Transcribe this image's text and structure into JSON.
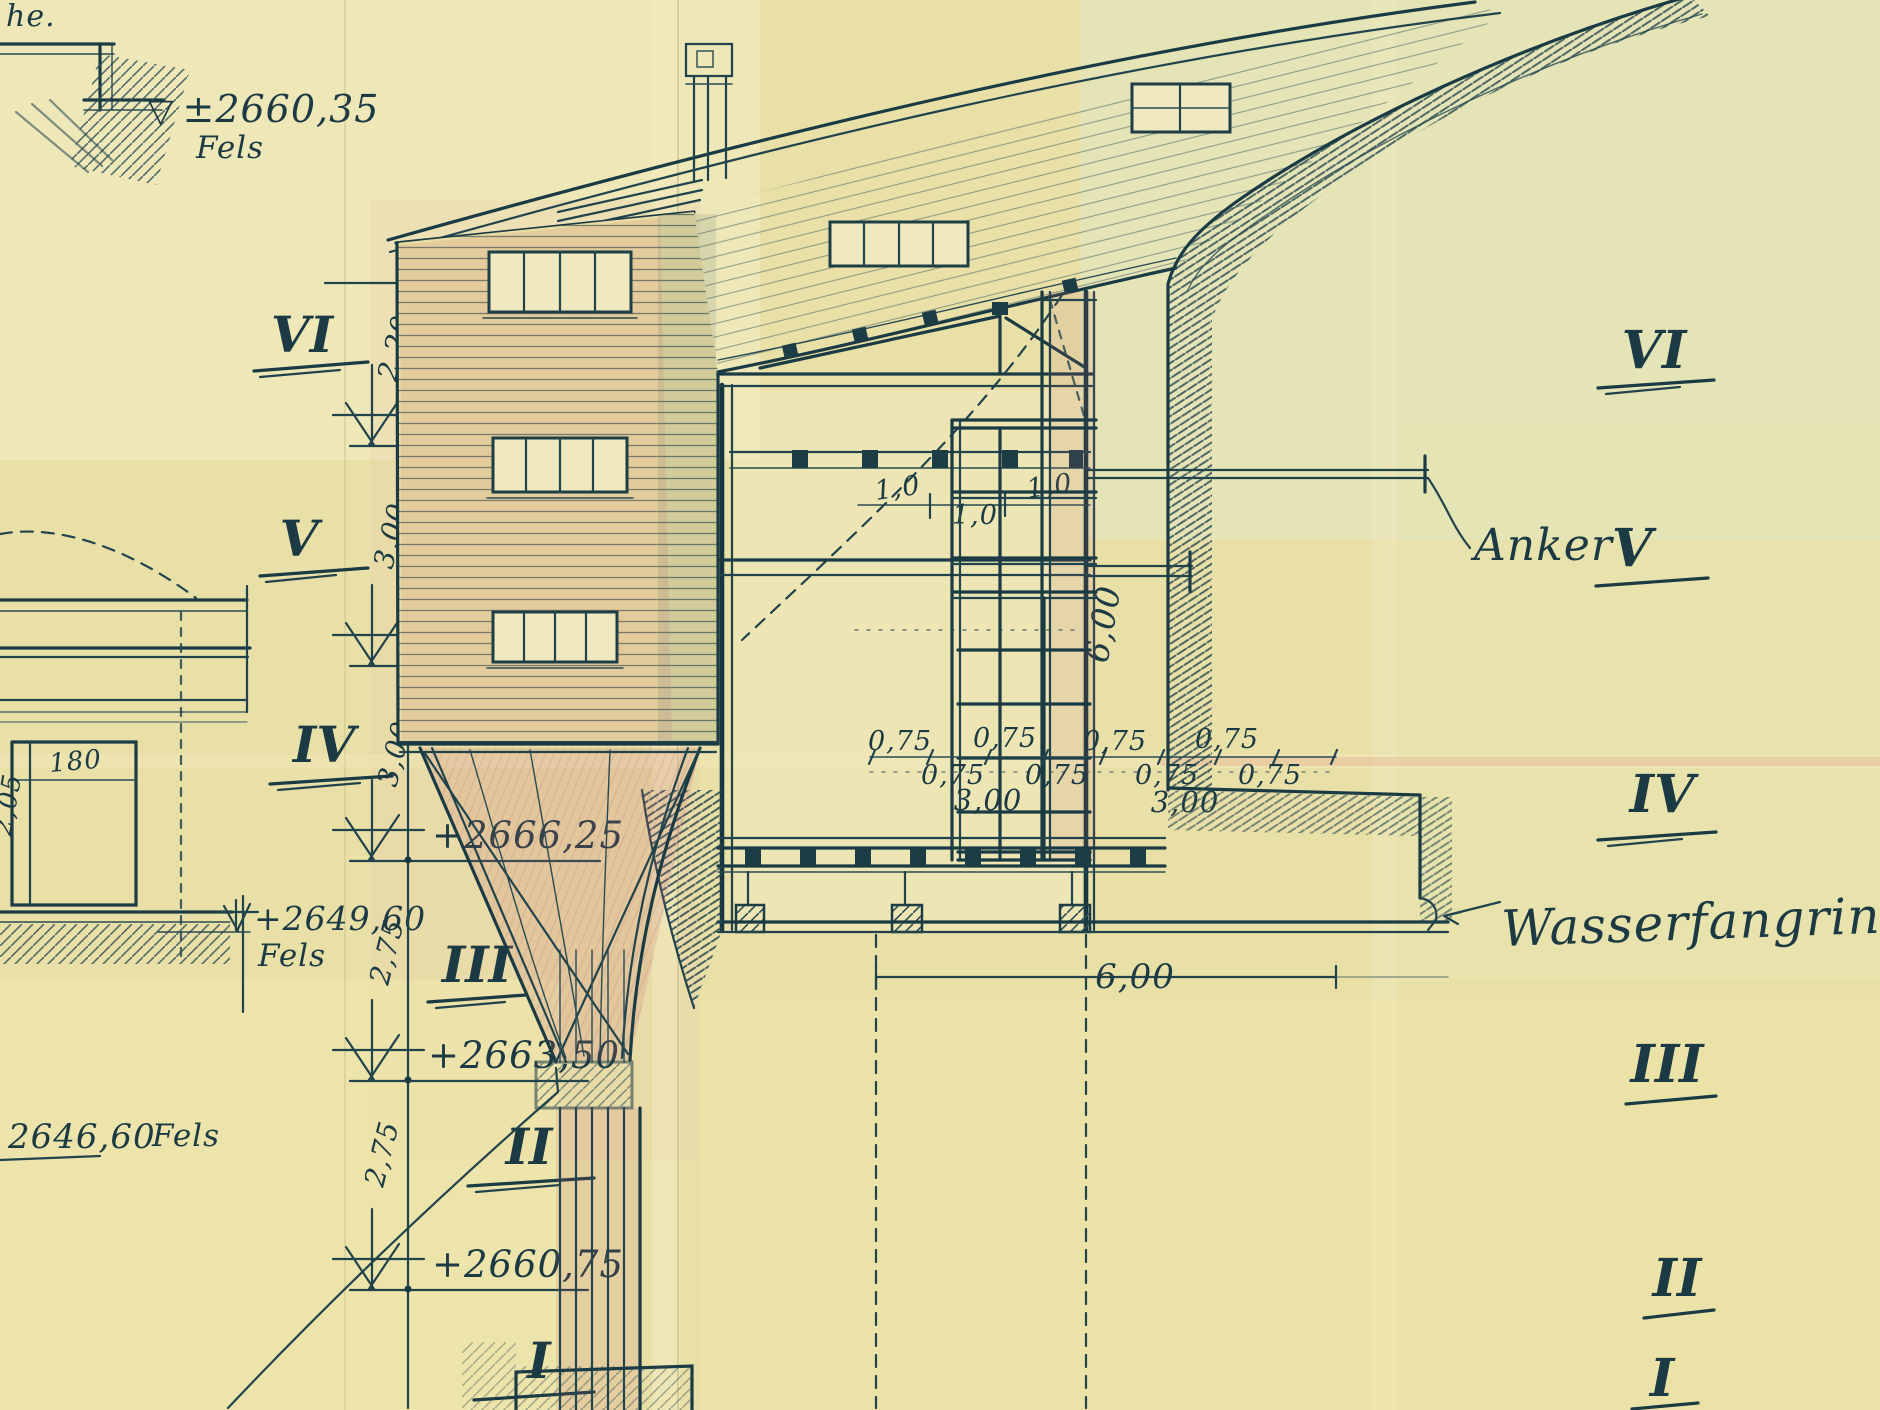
{
  "palette": {
    "paper": "#e9e0a8",
    "ink": "#20424b",
    "red_pencil": "#c4646c",
    "green_tint": "#dfe7c3"
  },
  "fragment_top_left": {
    "cut_text": "he.",
    "datum_symbol": "▽",
    "datum_value": "±2660,35",
    "datum_rock": "Fels"
  },
  "left_detail": {
    "door_width": "180",
    "door_height": "2,05",
    "datum_value": "+2649,60",
    "datum_rock": "Fels",
    "datum2_value": "2646,60",
    "datum2_rock": "Fels"
  },
  "left_levels": {
    "numerals": [
      "VI",
      "V",
      "IV",
      "III",
      "II",
      "I"
    ],
    "spacings": [
      "2,20",
      "3,00",
      "3,00",
      "2,75",
      "2,75"
    ],
    "elevations": [
      "+2672,25",
      "+2669,25",
      "+2666,25",
      "+2663,50",
      "+2660,75"
    ]
  },
  "right_levels": {
    "numerals": [
      "VI",
      "V",
      "IV",
      "III",
      "II",
      "I"
    ]
  },
  "labels": {
    "anker": "Anker",
    "wasserfangrinne": "Wasserfangrinne"
  },
  "section_dims": {
    "roof_bays": [
      "1,0",
      "1,0",
      "1,0"
    ],
    "interior_height": "6,00",
    "wall_bays_upper": [
      "0,75",
      "0,75",
      "0,75",
      "0,75"
    ],
    "wall_bays_lower": [
      "0,75",
      "0,75",
      "0,75",
      "0,75"
    ],
    "wall_totals": [
      "3,00",
      "3,00"
    ],
    "base_width": "6,00"
  }
}
